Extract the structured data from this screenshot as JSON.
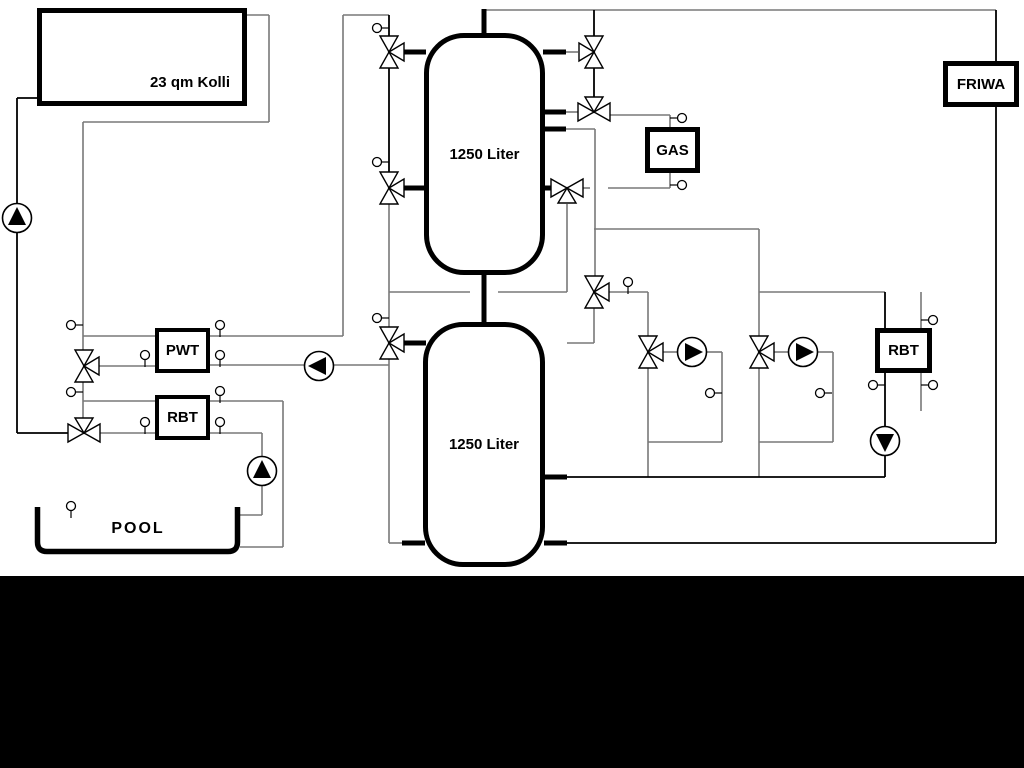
{
  "labels": {
    "collector": "23 qm Kolli",
    "tank_top": "1250 Liter",
    "tank_bottom": "1250 Liter",
    "pwt": "PWT",
    "rbt_left": "RBT",
    "gas": "GAS",
    "friwa": "FRIWA",
    "rbt_right": "RBT",
    "pool": "POOL"
  },
  "colors": {
    "background": "#ffffff",
    "pipe_gray": "#787878",
    "pipe_black": "#000000",
    "symbol_fill": "#ffffff",
    "pump_triangle": "#000000",
    "bottom_band": "#000000"
  },
  "icons": {
    "pump": "pump-icon",
    "three_way_valve": "three-way-valve-icon",
    "temperature_sensor": "temperature-sensor-icon"
  }
}
